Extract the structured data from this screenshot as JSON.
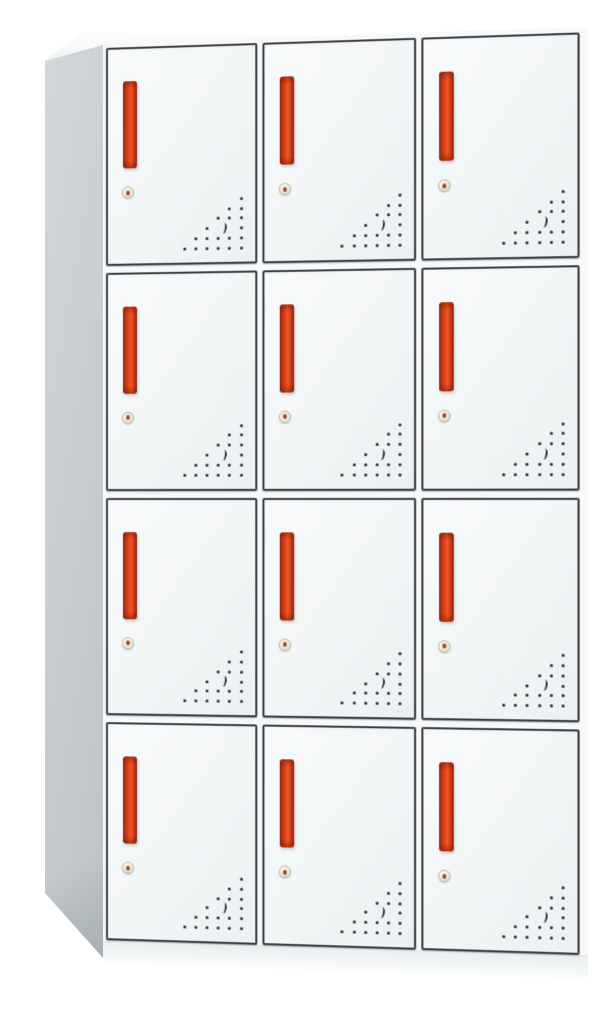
{
  "scene": {
    "type": "product-photo",
    "subject": "12-door metal office locker cabinet, white body with red recessed handles",
    "background_color": "#ffffff"
  },
  "cabinet": {
    "rows": 4,
    "columns": 3,
    "door_count": 12,
    "doors": [
      {
        "row": 1,
        "col": 1
      },
      {
        "row": 1,
        "col": 2
      },
      {
        "row": 1,
        "col": 3
      },
      {
        "row": 2,
        "col": 1
      },
      {
        "row": 2,
        "col": 2
      },
      {
        "row": 2,
        "col": 3
      },
      {
        "row": 3,
        "col": 1
      },
      {
        "row": 3,
        "col": 2
      },
      {
        "row": 3,
        "col": 3
      },
      {
        "row": 4,
        "col": 1
      },
      {
        "row": 4,
        "col": 2
      },
      {
        "row": 4,
        "col": 3
      }
    ],
    "door_features": {
      "handle_icon": "vertical-bar-handle-icon",
      "lock_icon": "keyhole-lock-icon",
      "vent_icon": "vent-holes-triangle-icon"
    },
    "vent_pattern_rows": [
      1,
      2,
      3,
      4,
      5,
      6
    ]
  },
  "colors": {
    "background": "#ffffff",
    "door_face": "#f3f5f6",
    "frame_outline": "#3e4247",
    "side_panel": "#c6ccce",
    "top_panel": "#f6f8f9",
    "base_strip": "#eef1f2",
    "handle_red": "#e8491d",
    "handle_red_dark": "#8f1f10",
    "lock_face": "#efe9d6",
    "vent_dot": "#2d3033"
  }
}
